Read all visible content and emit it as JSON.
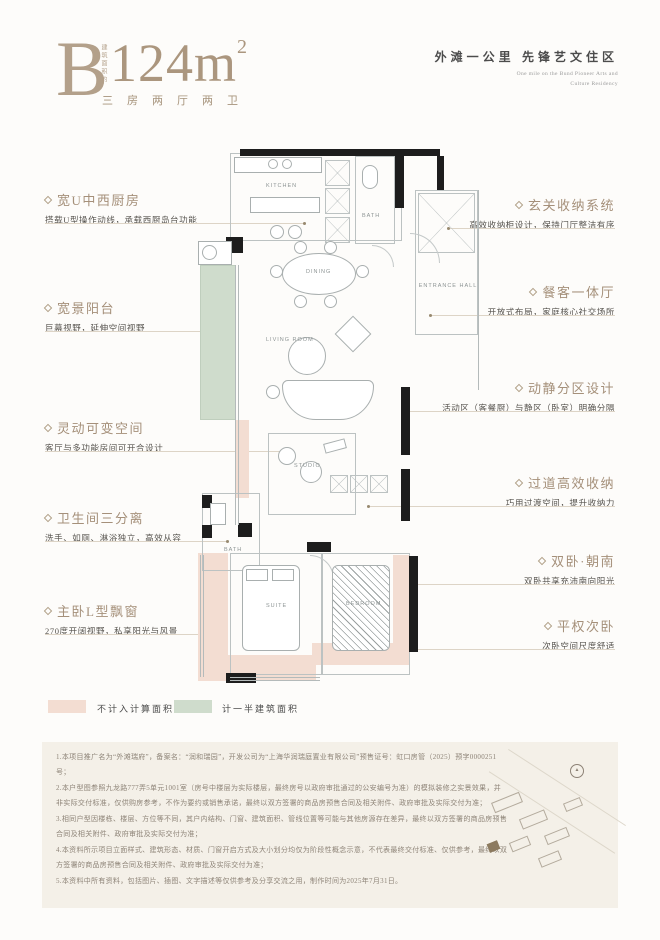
{
  "header": {
    "plan_letter": "B",
    "area_prefix_vertical": "建筑面积约",
    "area_number": "124m",
    "area_exponent": "2",
    "rooms_spec": "三房两厅两卫",
    "tagline_cn": "外滩一公里  先锋艺文住区",
    "tagline_en_line1": "One mile on the Bund Pioneer Arts and",
    "tagline_en_line2": "Culture Residency"
  },
  "annotations": {
    "left": [
      {
        "title": "宽U中西厨房",
        "desc": "搭载U型操作动线，承载西厨岛台功能"
      },
      {
        "title": "宽景阳台",
        "desc": "巨幕视野，延伸空间视野"
      },
      {
        "title": "灵动可变空间",
        "desc": "客厅与多功能房间可开合设计"
      },
      {
        "title": "卫生间三分离",
        "desc": "洗手、如厕、淋浴独立，高效从容"
      },
      {
        "title": "主卧L型飘窗",
        "desc": "270度开阔视野，私享阳光与风景"
      }
    ],
    "right": [
      {
        "title": "玄关收纳系统",
        "desc": "高效收纳柜设计，保持门厅整洁有序"
      },
      {
        "title": "餐客一体厅",
        "desc": "开放式布局，家庭核心社交场所"
      },
      {
        "title": "动静分区设计",
        "desc": "活动区（客餐厨）与静区（卧室）明确分隔"
      },
      {
        "title": "过道高效收纳",
        "desc": "巧用过渡空间，提升收纳力"
      },
      {
        "title": "双卧·朝南",
        "desc": "双卧共享充沛南向阳光"
      },
      {
        "title": "平权次卧",
        "desc": "次卧空间尺度舒适"
      }
    ]
  },
  "plan": {
    "rooms": [
      {
        "label": "KITCHEN"
      },
      {
        "label": "BATH"
      },
      {
        "label": "DINING"
      },
      {
        "label": "ENTRANCE HALL"
      },
      {
        "label": "LIVING ROOM"
      },
      {
        "label": "STUDIO"
      },
      {
        "label": "BATH"
      },
      {
        "label": "SUITE"
      },
      {
        "label": "BEDROOM"
      }
    ]
  },
  "legend": [
    {
      "label": "不计入计算面积",
      "color": "#f3ddd2"
    },
    {
      "label": "计一半建筑面积",
      "color": "#cfdccc"
    }
  ],
  "disclaimer": {
    "lines": [
      "1.本项目推广名为“外滩瑞府”，备案名：“润和瑞园”，开发公司为“上海华润瑞庭置业有限公司”预售证号：虹口房管（2025）预字0000251号；",
      "2.本户型图参照九龙路777弄5单元1001室（房号中楼层为实际楼层，最终房号以政府审批通过的公安编号为准）的模拟装修之实景效果，并非实际交付标准，仅供购房参考，不作为要约或销售承诺，最终以双方签署的商品房预售合同及相关附件、政府审批及实际交付为准；",
      "3.相同户型因楼栋、楼层、方位等不同，其户内结构、门窗、建筑面积、管线位置等可能与其他房源存在差异，最终以双方签署的商品房预售合同及相关附件、政府审批及实际交付为准；",
      "4.本资料所示项目立面样式、建筑形态、材质、门窗开启方式及大小划分均仅为阶段性概念示意，不代表最终交付标准、仅供参考，最终以双方签署的商品房预售合同及相关附件、政府审批及实际交付为准；",
      "5.本资料中所有资料，包括图片、插图、文字描述等仅供参考及分享交流之用，制作时间为2025年7月31日。"
    ]
  },
  "colors": {
    "accent_bronze": "#a5907a",
    "pink_area": "#f3ddd2",
    "green_area": "#cfdccc",
    "wall_black": "#1d1d1d",
    "disclaimer_bg": "#f4f0e8"
  }
}
